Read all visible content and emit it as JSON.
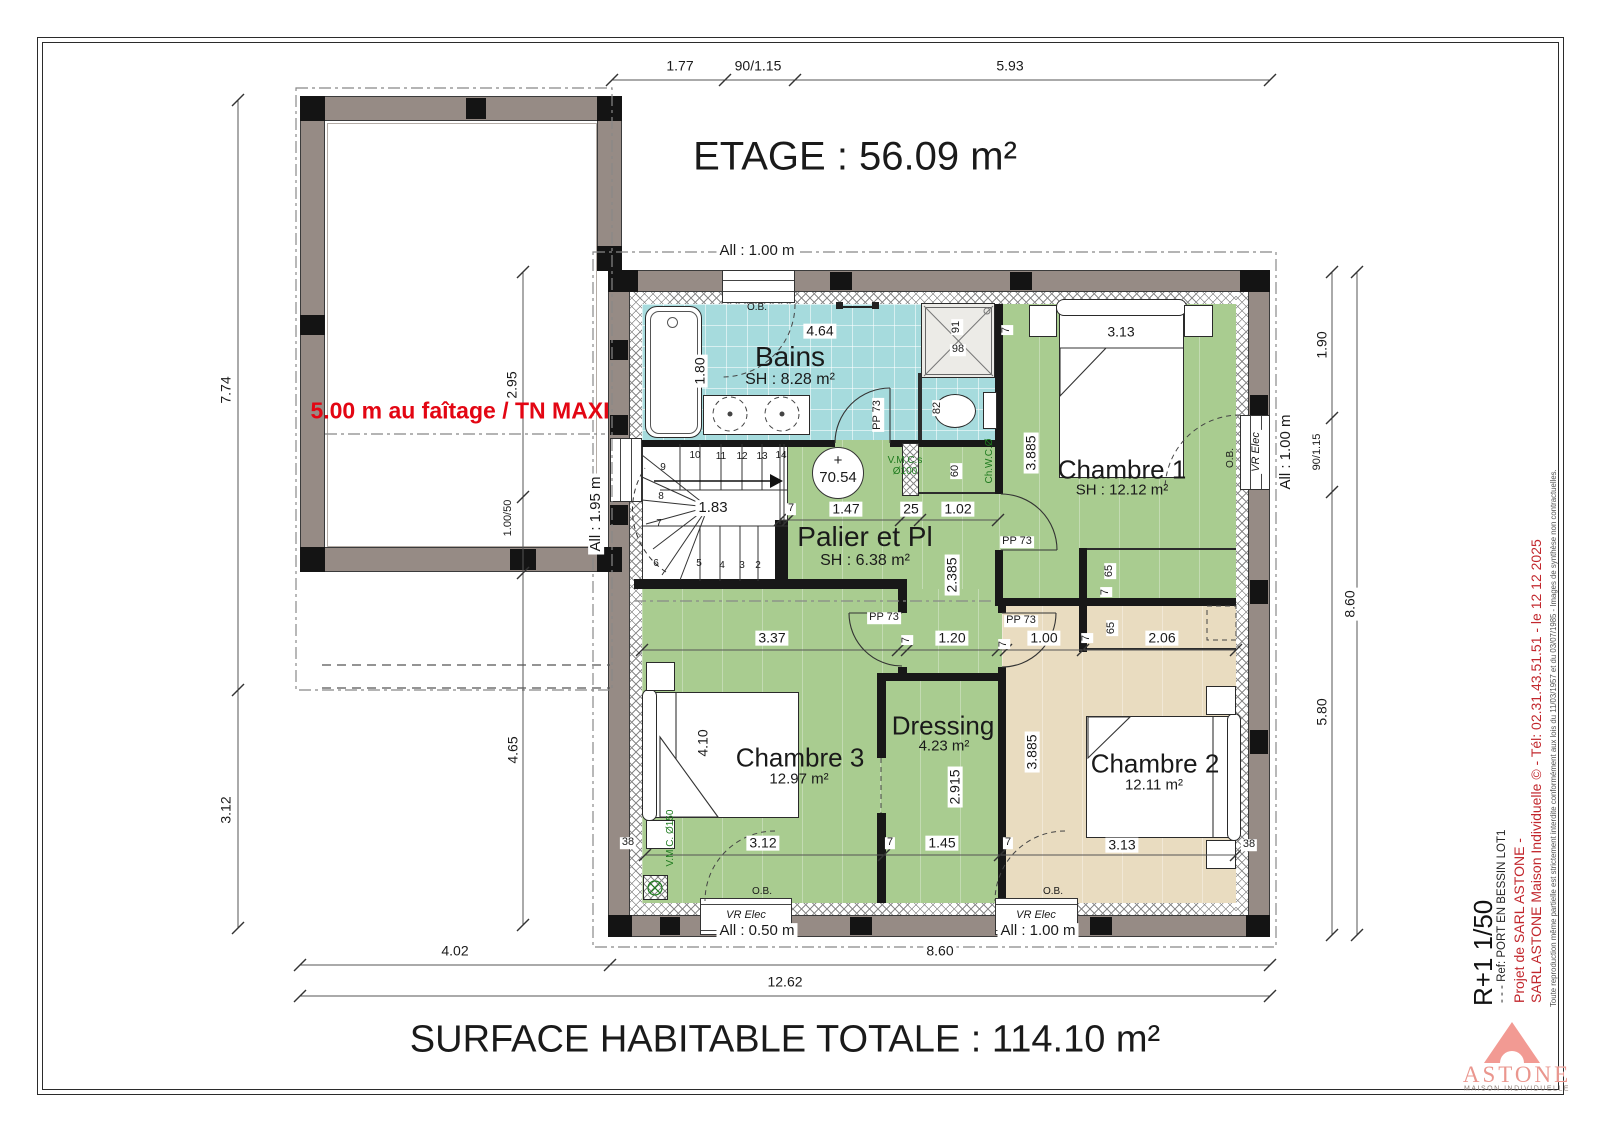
{
  "sheet": {
    "floor_title": "ETAGE : 56.09 m²",
    "total_title": "SURFACE HABITABLE TOTALE : 114.10 m²",
    "red_note": "5.00 m au faîtage / TN MAXI"
  },
  "rooms": {
    "bains": {
      "name": "Bains",
      "area": "SH : 8.28 m²"
    },
    "palier": {
      "name": "Palier et Pl",
      "area": "SH : 6.38 m²"
    },
    "chambre1": {
      "name": "Chambre 1",
      "area": "SH : 12.12 m²"
    },
    "chambre2": {
      "name": "Chambre 2",
      "area": "12.11 m²"
    },
    "chambre3": {
      "name": "Chambre 3",
      "area": "12.97 m²"
    },
    "dressing": {
      "name": "Dressing",
      "area": "4.23 m²"
    }
  },
  "dims": {
    "t1": "1.77",
    "t2": "90/1.15",
    "t3": "5.93",
    "l1": "7.74",
    "l2": "3.12",
    "m1": "2.95",
    "m2": "1.00/50",
    "m3": "4.65",
    "r1": "1.90",
    "r2": "90/1.15",
    "r3": "5.80",
    "r4": "8.60",
    "b1": "4.02",
    "b2": "8.60",
    "b3": "12.62",
    "bains_w": "4.64",
    "bains_tub": "1.80",
    "shower_w": "91",
    "shower_h": "98",
    "wc": "82",
    "pl60": "60",
    "p147": "1.47",
    "p25": "25",
    "p102": "1.02",
    "p2385": "2.385",
    "p337": "3.37",
    "p120": "1.20",
    "c1_w": "3.13",
    "c1_h": "3.885",
    "c2_w": "3.13",
    "c2_h": "3.885",
    "c65": "65",
    "c206": "2.06",
    "c100": "1.00",
    "c3_h": "4.10",
    "c3_w": "3.12",
    "dr_h": "2.915",
    "dr_w": "1.45",
    "w7": "7",
    "w38": "38"
  },
  "windows": {
    "all_100": "All : 1.00 m",
    "all_195": "All : 1.95 m",
    "all_050": "All : 0.50 m",
    "vr": "VR Elec",
    "ob": "O.B."
  },
  "annotations": {
    "level": "70.54",
    "plus": "+",
    "pp73": "PP 73",
    "vmc_s": "V.M.C.s",
    "vmc_s_d": "Ø100",
    "vmc_150": "V.M.C. Ø150",
    "chwc": "Ch.W.C.Ø"
  },
  "stairs": {
    "width": "1.83",
    "steps": [
      "1",
      "2",
      "3",
      "4",
      "5",
      "6",
      "7",
      "8",
      "9",
      "10",
      "11",
      "12",
      "13",
      "14"
    ]
  },
  "titleblock": {
    "scale": "R+1 1/50",
    "ref": "- - - Ref: PORT EN BESSIN LOT1",
    "project1": "Projet de SARL ASTONE -",
    "project2": "SARL ASTONE Maison Individuelle © - Tél: 02.31.43.51.51 - le 12 12 2025",
    "disclaimer": "Toute reproduction même partielle est strictement interdite conformément aux lois du 11/03/1957 et du 03/07/1985 - Images de synthèse non contractuelles.",
    "logo": "ASTONE",
    "logo_sub": "MAISON INDIVIDUELLE"
  },
  "colors": {
    "floor_green": "#a9cc90",
    "floor_cyan": "#a6dbdd",
    "floor_beige": "#e9dcc0",
    "note_red": "#e30613",
    "brand_red": "#c2272d",
    "logo_pink": "#f29a93"
  }
}
